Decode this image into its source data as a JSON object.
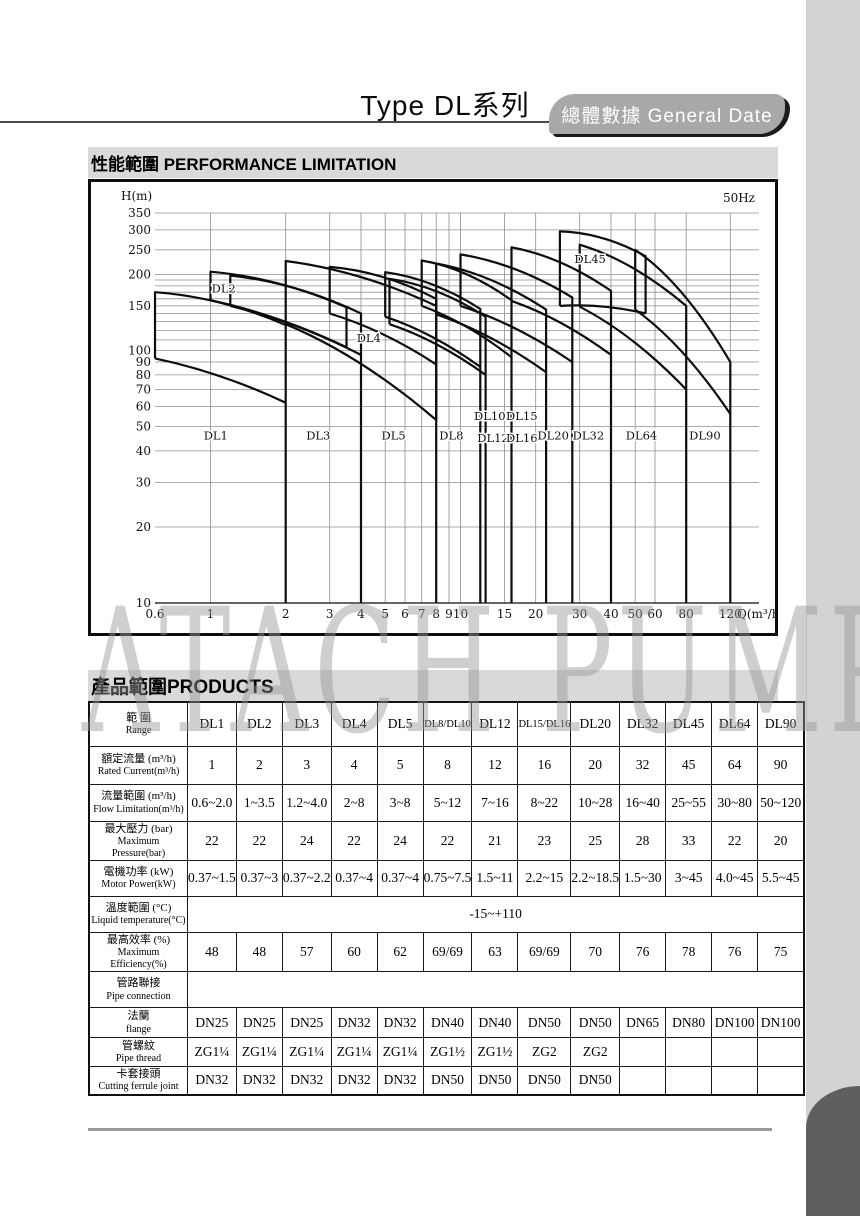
{
  "page": {
    "title": "Type DL系列",
    "tab_label": "總體數據 General Date",
    "watermark": "ATACH PUMP"
  },
  "sections": {
    "performance_heading": "性能範圍 PERFORMANCE LIMITATION",
    "products_heading": "產品範圍PRODUCTS"
  },
  "chart_data": {
    "type": "line",
    "title": "Performance limitation envelopes of DL pump series",
    "frequency_label": "50Hz",
    "ylabel": "H(m)",
    "xlabel": "Q(m³/h)",
    "x_scale": "log",
    "y_scale": "log",
    "xlim": [
      0.6,
      120
    ],
    "ylim": [
      10,
      350
    ],
    "x_ticks": [
      0.6,
      1,
      2,
      3,
      4,
      5,
      6,
      7,
      8,
      9,
      10,
      15,
      20,
      30,
      40,
      50,
      60,
      80,
      120
    ],
    "y_ticks": [
      10,
      20,
      30,
      40,
      50,
      60,
      70,
      80,
      90,
      100,
      150,
      200,
      250,
      300,
      350
    ],
    "minor_h_grid": [
      20,
      30,
      40,
      50,
      60,
      70,
      80,
      90,
      100,
      110,
      120,
      130,
      140,
      150,
      160,
      170,
      180,
      190,
      200,
      250,
      300,
      350
    ],
    "grid": true,
    "envelopes": [
      {
        "name": "DL1",
        "qmin": 0.6,
        "qmax": 2,
        "h_top": [
          170,
          126
        ],
        "h_bottom": [
          93,
          62
        ],
        "right_full_drop": true
      },
      {
        "name": "DL2",
        "qmin": 1,
        "qmax": 3.5,
        "h_top": [
          205,
          148
        ],
        "h_bottom": [
          158,
          103
        ],
        "right_full_drop": false
      },
      {
        "name": "DL3",
        "qmin": 1.2,
        "qmax": 4,
        "h_top": [
          198,
          140
        ],
        "h_bottom": [
          150,
          96
        ],
        "right_full_drop": true
      },
      {
        "name": "DL4",
        "qmin": 2,
        "qmax": 8,
        "h_top": [
          226,
          150
        ],
        "h_bottom": [
          127,
          53
        ],
        "right_full_drop": false
      },
      {
        "name": "DL5",
        "qmin": 3,
        "qmax": 8,
        "h_top": [
          214,
          160
        ],
        "h_bottom": [
          140,
          88
        ],
        "right_full_drop": true
      },
      {
        "name": "DL8",
        "qmin": 5,
        "qmax": 12,
        "h_top": [
          204,
          146
        ],
        "h_bottom": [
          136,
          86
        ],
        "right_full_drop": true
      },
      {
        "name": "DL10",
        "qmin": 5.2,
        "qmax": 12.6,
        "h_top": [
          192,
          136
        ],
        "h_bottom": [
          127,
          80
        ],
        "right_full_drop": true
      },
      {
        "name": "DL12",
        "qmin": 7,
        "qmax": 16,
        "h_top": [
          227,
          158
        ],
        "h_bottom": [
          150,
          94
        ],
        "right_full_drop": true
      },
      {
        "name": "DL15/DL16",
        "qmin": 8,
        "qmax": 22,
        "h_top": [
          221,
          145
        ],
        "h_bottom": [
          139,
          82
        ],
        "right_full_drop": true
      },
      {
        "name": "DL20",
        "qmin": 10,
        "qmax": 28,
        "h_top": [
          240,
          162
        ],
        "h_bottom": [
          150,
          90
        ],
        "right_full_drop": true
      },
      {
        "name": "DL32",
        "qmin": 16,
        "qmax": 40,
        "h_top": [
          256,
          172
        ],
        "h_bottom": [
          157,
          96
        ],
        "right_full_drop": true
      },
      {
        "name": "DL45",
        "qmin": 25,
        "qmax": 55,
        "h_top": [
          296,
          236
        ],
        "h_bottom": [
          150,
          140
        ],
        "right_full_drop": false
      },
      {
        "name": "DL64",
        "qmin": 30,
        "qmax": 80,
        "h_top": [
          262,
          150
        ],
        "h_bottom": [
          149,
          70
        ],
        "right_full_drop": true
      },
      {
        "name": "DL90",
        "qmin": 50,
        "qmax": 120,
        "h_top": [
          250,
          90
        ],
        "h_bottom": [
          145,
          56
        ],
        "right_full_drop": true
      }
    ],
    "curve_labels": [
      {
        "text": "DL2",
        "q": 1.13,
        "h": 176
      },
      {
        "text": "DL4",
        "q": 4.3,
        "h": 112
      },
      {
        "text": "DL45",
        "q": 33,
        "h": 230
      },
      {
        "text": "DL1",
        "q": 1.05,
        "h": 46
      },
      {
        "text": "DL3",
        "q": 2.7,
        "h": 46
      },
      {
        "text": "DL5",
        "q": 5.4,
        "h": 46
      },
      {
        "text": "DL8",
        "q": 9.2,
        "h": 46
      },
      {
        "text": "DL10",
        "q": 13.1,
        "h": 55
      },
      {
        "text": "DL12",
        "q": 13.5,
        "h": 45
      },
      {
        "text": "DL15",
        "q": 17.6,
        "h": 55
      },
      {
        "text": "DL16",
        "q": 17.6,
        "h": 45
      },
      {
        "text": "DL20",
        "q": 23.5,
        "h": 46
      },
      {
        "text": "DL32",
        "q": 32.5,
        "h": 46
      },
      {
        "text": "DL64",
        "q": 53,
        "h": 46
      },
      {
        "text": "DL90",
        "q": 95,
        "h": 46
      }
    ]
  },
  "products_table": {
    "header": {
      "zh": "範  圍",
      "en": "Range"
    },
    "columns": [
      "DL1",
      "DL2",
      "DL3",
      "DL4",
      "DL5",
      "DL8/DL10",
      "DL12",
      "DL15/DL16",
      "DL20",
      "DL32",
      "DL45",
      "DL64",
      "DL90"
    ],
    "rows": [
      {
        "zh": "額定流量 (m³/h)",
        "en": "Rated Current(m³/h)",
        "type": "cells",
        "values": [
          "1",
          "2",
          "3",
          "4",
          "5",
          "8",
          "12",
          "16",
          "20",
          "32",
          "45",
          "64",
          "90"
        ]
      },
      {
        "zh": "流量範圍 (m³/h)",
        "en": "Flow Limitation(m³/h)",
        "type": "cells",
        "values": [
          "0.6~2.0",
          "1~3.5",
          "1.2~4.0",
          "2~8",
          "3~8",
          "5~12",
          "7~16",
          "8~22",
          "10~28",
          "16~40",
          "25~55",
          "30~80",
          "50~120"
        ]
      },
      {
        "zh": "最大壓力 (bar)",
        "en": "Maximum Pressure(bar)",
        "type": "cells",
        "values": [
          "22",
          "22",
          "24",
          "22",
          "24",
          "22",
          "21",
          "23",
          "25",
          "28",
          "33",
          "22",
          "20"
        ]
      },
      {
        "zh": "電機功率 (kW)",
        "en": "Motor Power(kW)",
        "type": "cells",
        "values": [
          "0.37~1.5",
          "0.37~3",
          "0.37~2.2",
          "0.37~4",
          "0.37~4",
          "0.75~7.5",
          "1.5~11",
          "2.2~15",
          "2.2~18.5",
          "1.5~30",
          "3~45",
          "4.0~45",
          "5.5~45"
        ]
      },
      {
        "zh": "溫度範圍 (°C)",
        "en": "Liquid temperature(°C)",
        "type": "span",
        "value": "-15~+110",
        "span_class": "temp-span"
      },
      {
        "zh": "最高效率 (%)",
        "en": "Maximum Efficiency(%)",
        "type": "cells",
        "values": [
          "48",
          "48",
          "57",
          "60",
          "62",
          "69/69",
          "63",
          "69/69",
          "70",
          "76",
          "78",
          "76",
          "75"
        ]
      },
      {
        "zh": "管路聯接",
        "en": "Pipe connection",
        "type": "span",
        "value": "",
        "span_class": ""
      },
      {
        "zh": "法蘭",
        "en": "flange",
        "type": "cells",
        "values": [
          "DN25",
          "DN25",
          "DN25",
          "DN32",
          "DN32",
          "DN40",
          "DN40",
          "DN50",
          "DN50",
          "DN65",
          "DN80",
          "DN100",
          "DN100"
        ]
      },
      {
        "zh": "管螺紋",
        "en": "Pipe thread",
        "type": "cells",
        "values": [
          "ZG1¼",
          "ZG1¼",
          "ZG1¼",
          "ZG1¼",
          "ZG1¼",
          "ZG1½",
          "ZG1½",
          "ZG2",
          "ZG2",
          "",
          "",
          "",
          ""
        ]
      },
      {
        "zh": "卡套接頭",
        "en": "Cutting ferrule joint",
        "type": "cells",
        "values": [
          "DN32",
          "DN32",
          "DN32",
          "DN32",
          "DN32",
          "DN50",
          "DN50",
          "DN50",
          "DN50",
          "",
          "",
          "",
          ""
        ]
      }
    ]
  }
}
